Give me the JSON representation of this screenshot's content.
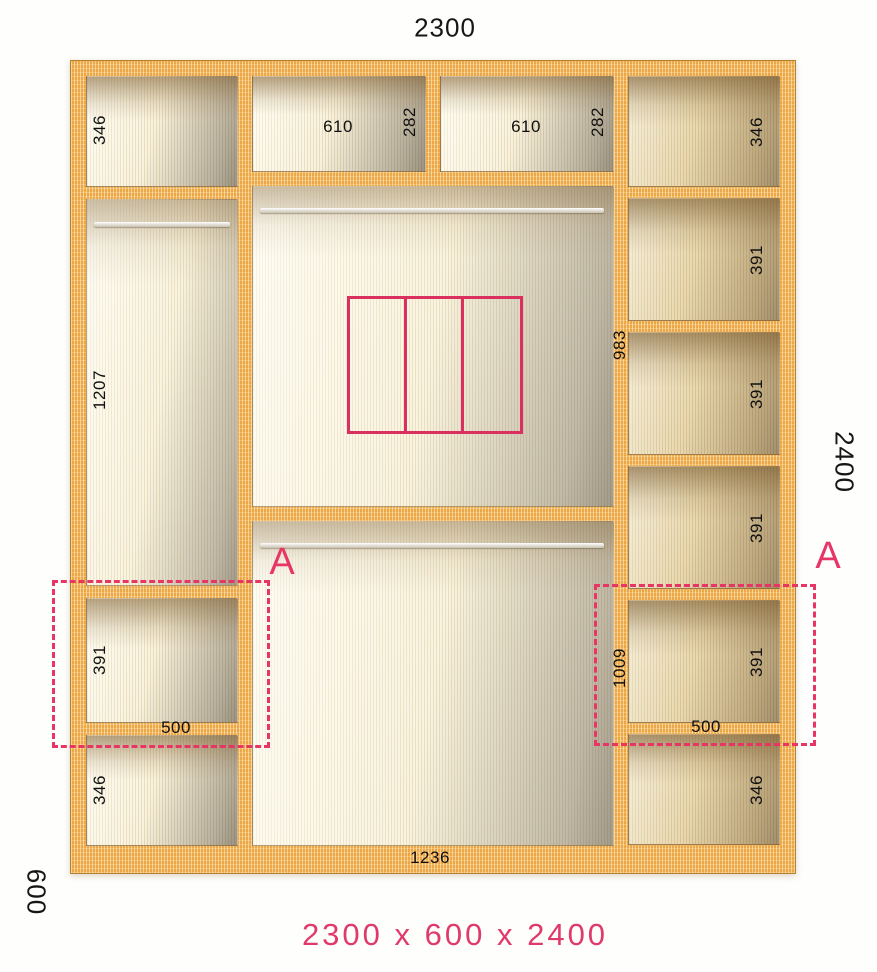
{
  "caption": "2300 x 600 x 2400",
  "outer_dims": {
    "width": "2300",
    "height": "2400",
    "depth": "600"
  },
  "marker": "A",
  "left_column": {
    "top_height": "346",
    "hang_height": "1207",
    "shelf_height": "391",
    "shelf_width": "500",
    "bottom_height": "346"
  },
  "middle": {
    "left_width": "610",
    "left_height": "282",
    "right_width": "610",
    "right_height": "282",
    "upper_height": "983",
    "lower_height": "1009",
    "bottom_width": "1236"
  },
  "right_column": {
    "top_height": "346",
    "shelf_heights": [
      "391",
      "391",
      "391",
      "391"
    ],
    "shelf_width": "500",
    "bottom_height": "346"
  },
  "colors": {
    "wood": "#f0ad4c",
    "interior_cream": "#f5eed6",
    "accent_pink": "#e73666",
    "caption_pink": "#e03a6c",
    "label_black": "#101010"
  }
}
